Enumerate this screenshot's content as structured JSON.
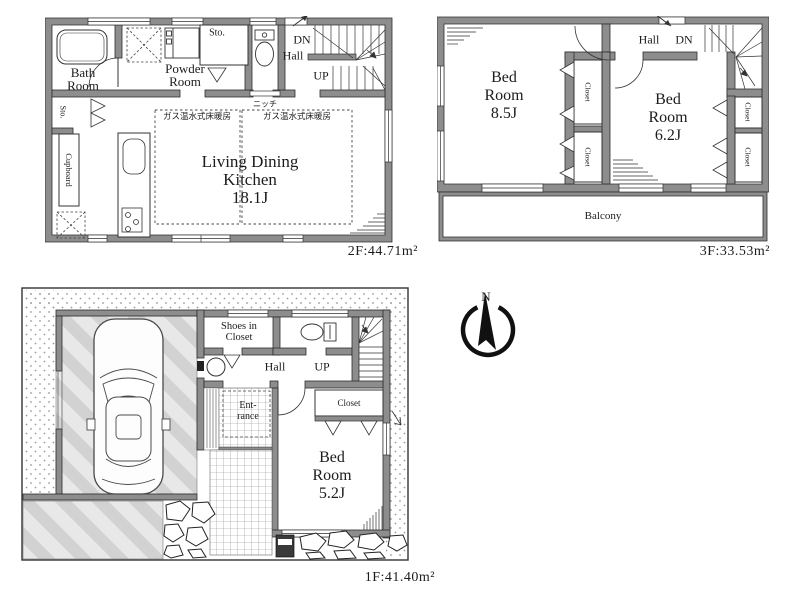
{
  "colors": {
    "wall": "#8d8d8d",
    "line": "#2e2e2e",
    "stripe": "#d2d2d2",
    "stripe_bg": "#e8e8e8",
    "dot": "#9a9a9a"
  },
  "compass": {
    "north": "N"
  },
  "f2": {
    "area": "2F:44.71m²",
    "bath": [
      "Bath",
      "Room"
    ],
    "powder": [
      "Powder",
      "Room"
    ],
    "sto_top": "Sto.",
    "dn": "DN",
    "hall": "Hall",
    "up": "UP",
    "niche": "ニッチ",
    "heat_left": "ガス温水式床暖房",
    "heat_right": "ガス温水式床暖房",
    "ldk": [
      "Living Dining",
      "Kitchen",
      "18.1J"
    ],
    "sto_left": "Sto.",
    "cupboard": "Cupboard"
  },
  "f3": {
    "area": "3F:33.53m²",
    "hall": "Hall",
    "dn": "DN",
    "bed1": [
      "Bed",
      "Room",
      "8.5J"
    ],
    "bed2": [
      "Bed",
      "Room",
      "6.2J"
    ],
    "closet_mid_top": "Closet",
    "closet_mid_bottom": "Closet",
    "closet_right_top": "Closet",
    "closet_right_bottom": "Closet",
    "balcony": "Balcony"
  },
  "f1": {
    "area": "1F:41.40m²",
    "shoes": [
      "Shoes in",
      "Closet"
    ],
    "hall": "Hall",
    "up": "UP",
    "entrance": [
      "Ent-",
      "rance"
    ],
    "closet": "Closet",
    "bed": [
      "Bed",
      "Room",
      "5.2J"
    ]
  }
}
